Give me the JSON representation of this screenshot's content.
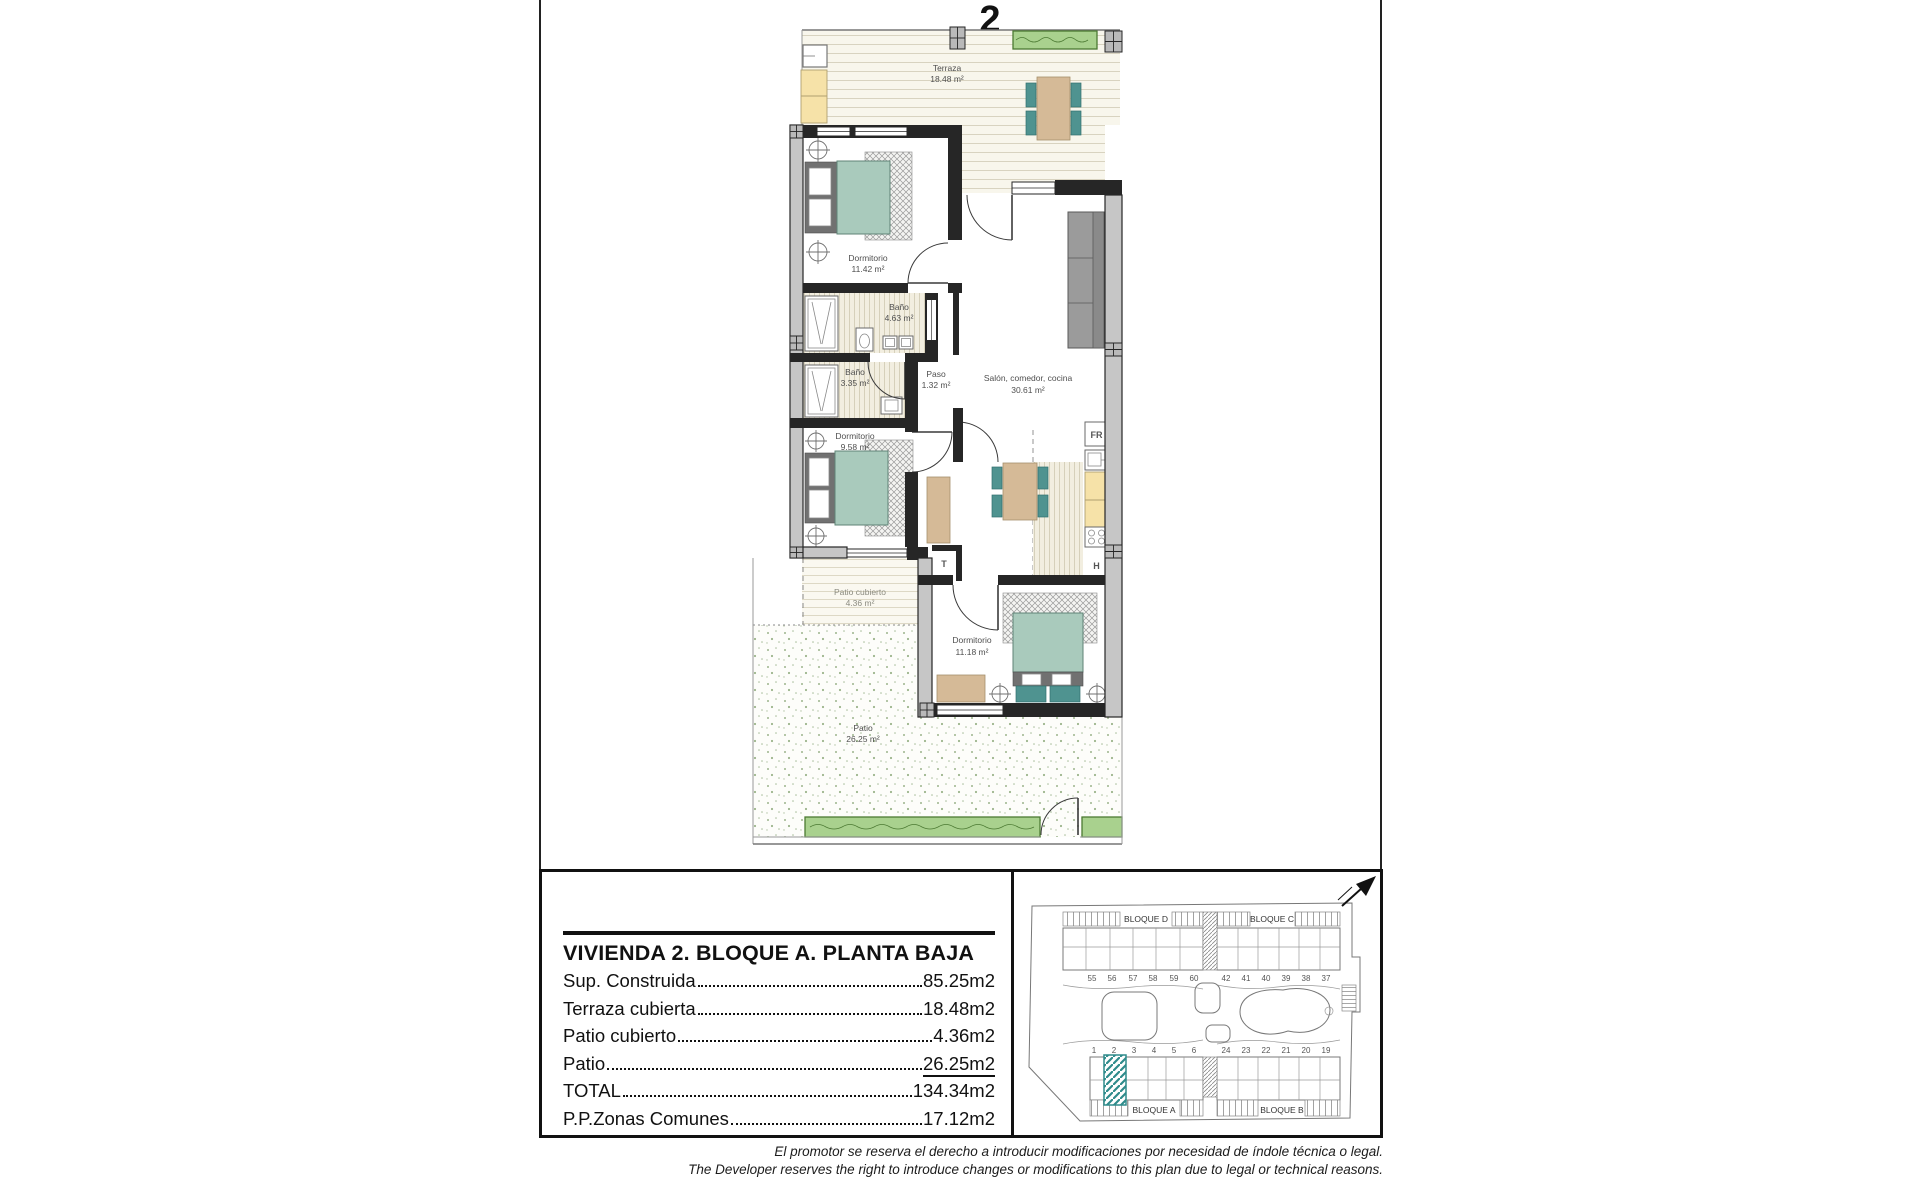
{
  "unit_number": "2",
  "plan": {
    "rooms": {
      "terraza": {
        "name": "Terraza",
        "area": "18.48 m²"
      },
      "dormitorio1": {
        "name": "Dormitorio",
        "area": "11.42 m²"
      },
      "bano1": {
        "name": "Baño",
        "area": "4.63 m²"
      },
      "bano2": {
        "name": "Baño",
        "area": "3.35 m²"
      },
      "paso": {
        "name": "Paso",
        "area": "1.32 m²"
      },
      "dormitorio2": {
        "name": "Dormitorio",
        "area": "9.58 m²"
      },
      "salon": {
        "name": "Salón, comedor, cocina",
        "area": "30.61 m²"
      },
      "dormitorio3": {
        "name": "Dormitorio",
        "area": "11.18 m²"
      },
      "patio_cubierto": {
        "name": "Patio cubierto",
        "area": "4.36 m²"
      },
      "patio": {
        "name": "Patio",
        "area": "26.25 m²"
      }
    },
    "appliances": {
      "fridge": "FR",
      "hob": "H",
      "wardrobe": "T"
    }
  },
  "info_panel": {
    "title": "VIVIENDA 2. BLOQUE A. PLANTA BAJA",
    "rows": [
      {
        "label": "Sup. Construida",
        "value": "85.25m2"
      },
      {
        "label": "Terraza cubierta",
        "value": "18.48m2"
      },
      {
        "label": "Patio cubierto",
        "value": "4.36m2"
      },
      {
        "label": "Patio",
        "value": "26.25m2"
      },
      {
        "label": "TOTAL",
        "value": "134.34m2"
      },
      {
        "label": "P.P.Zonas Comunes",
        "value": "17.12m2"
      }
    ]
  },
  "site_plan": {
    "blocks": {
      "a": "BLOQUE A",
      "b": "BLOQUE B",
      "c": "BLOQUE C",
      "d": "BLOQUE D"
    },
    "top_left_numbers": [
      "55",
      "56",
      "57",
      "58",
      "59",
      "60"
    ],
    "top_right_numbers": [
      "42",
      "41",
      "40",
      "39",
      "38",
      "37"
    ],
    "bottom_left_numbers": [
      "1",
      "2",
      "3",
      "4",
      "5",
      "6"
    ],
    "bottom_right_numbers": [
      "24",
      "23",
      "22",
      "21",
      "20",
      "19"
    ],
    "highlight_color": "#2e8b8b"
  },
  "disclaimer": {
    "es": "El promotor se reserva el derecho a introducir modificaciones por necesidad de índole técnica o legal.",
    "en": "The Developer reserves the right to introduce changes or modifications to this plan due to legal or technical reasons."
  },
  "colors": {
    "wall": "#262626",
    "bed_teal": "#a9cabc",
    "chair_teal": "#4f9390",
    "wood_tan": "#d5ba97",
    "counter_yellow": "#f6e2a8",
    "hedge_green": "#a9d18e"
  }
}
